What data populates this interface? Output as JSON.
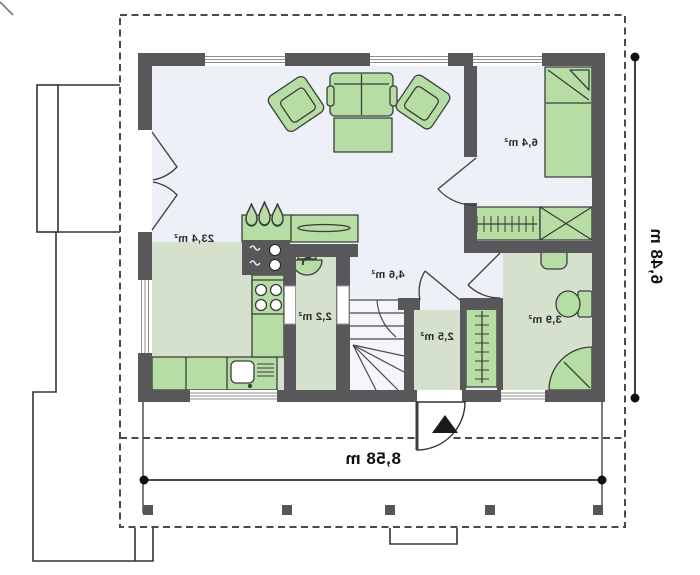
{
  "plan": {
    "rooms": [
      {
        "id": "living-kitchen",
        "area_label": "23,4 m²"
      },
      {
        "id": "bedroom",
        "area_label": "6,4 m²"
      },
      {
        "id": "hall",
        "area_label": "4,6 m²"
      },
      {
        "id": "pantry",
        "area_label": "2,2 m²"
      },
      {
        "id": "vestibule",
        "area_label": "2,5 m²"
      },
      {
        "id": "bathroom",
        "area_label": "3,9 m²"
      }
    ],
    "dimensions": {
      "overall_width_label": "8,58 m",
      "overall_depth_label": "6,48 m"
    },
    "mirrored_rendering": true,
    "colors": {
      "wall": "#58585a",
      "floor_light": "#edf1f7",
      "floor_green": "#d6e1cd",
      "furniture_green": "#b6dda3",
      "furniture_outline": "#3c3c3c",
      "dashed_boundary": "#4a4a4a",
      "dimension_line": "#111111",
      "entrance_arrow": "#1a1a1a"
    },
    "symbols": [
      "sofa",
      "armchair",
      "coffee-table",
      "fireplace",
      "kitchen-counter",
      "cooktop",
      "kitchen-sink",
      "chimney-flues",
      "washbasin",
      "bed",
      "wardrobe-hangers",
      "shaft-box",
      "stairs",
      "toilet",
      "shower",
      "closet-hangers",
      "entrance-arrow",
      "porch-posts",
      "french-door",
      "window"
    ]
  }
}
